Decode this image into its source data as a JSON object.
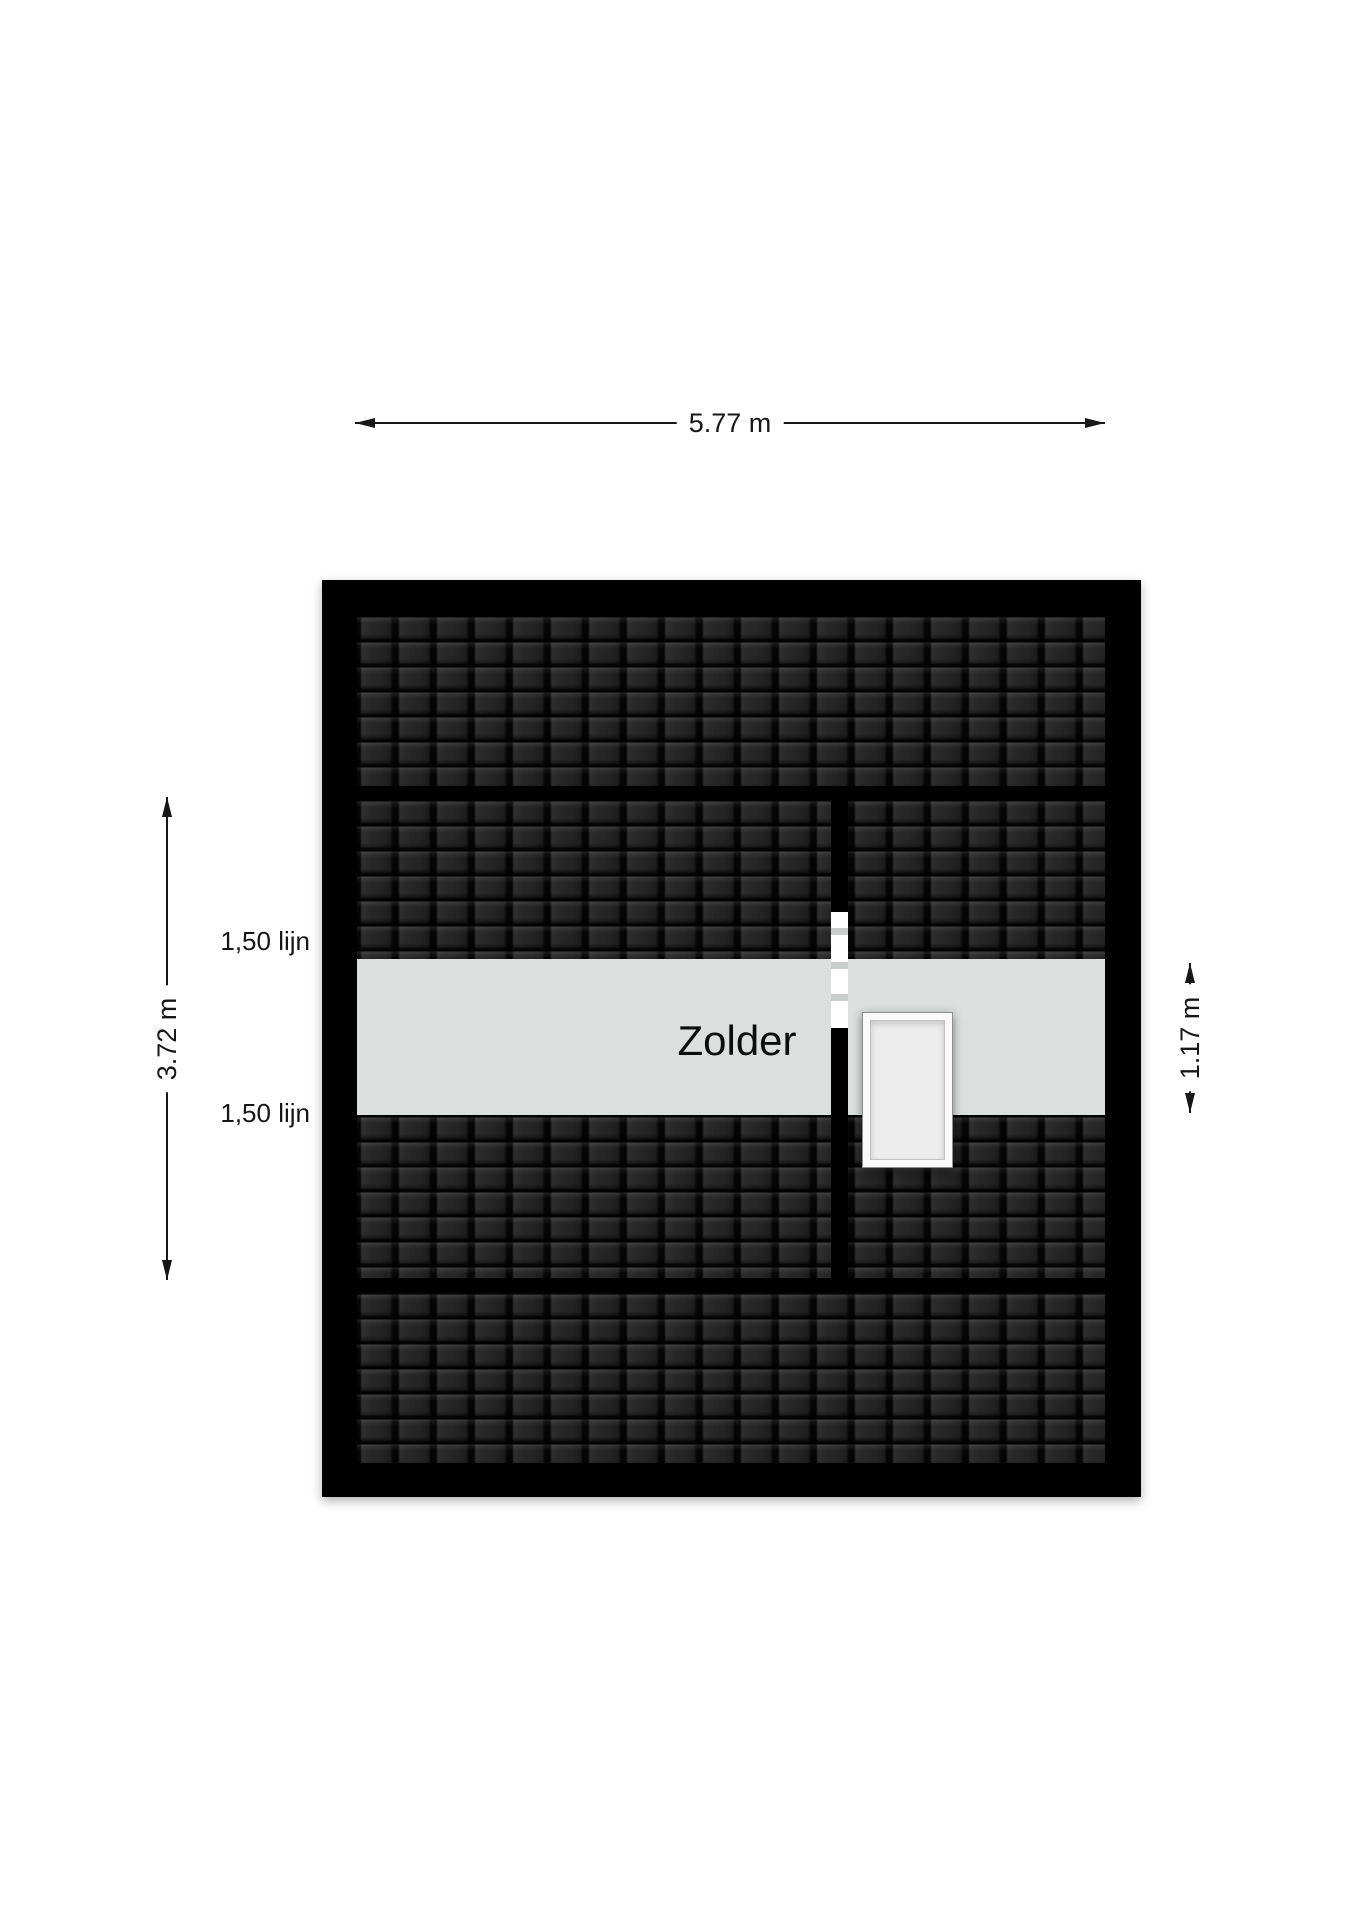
{
  "room": {
    "label": "Zolder"
  },
  "dimensions": {
    "width": {
      "label": "5.77 m"
    },
    "depth": {
      "label": "3.72 m"
    },
    "band_height": {
      "label": "1.17 m"
    }
  },
  "height_lines": [
    {
      "label": "1,50 lijn"
    },
    {
      "label": "1,50 lijn"
    }
  ],
  "colors": {
    "background": "#ffffff",
    "wall": "#000000",
    "roof_tiles": "#242424",
    "floor": "#dbdfde",
    "skylight_frame": "#fafafa",
    "skylight_glass": "#ededed",
    "door_mark": "#c9cdcc",
    "dimension_text": "#171717"
  }
}
